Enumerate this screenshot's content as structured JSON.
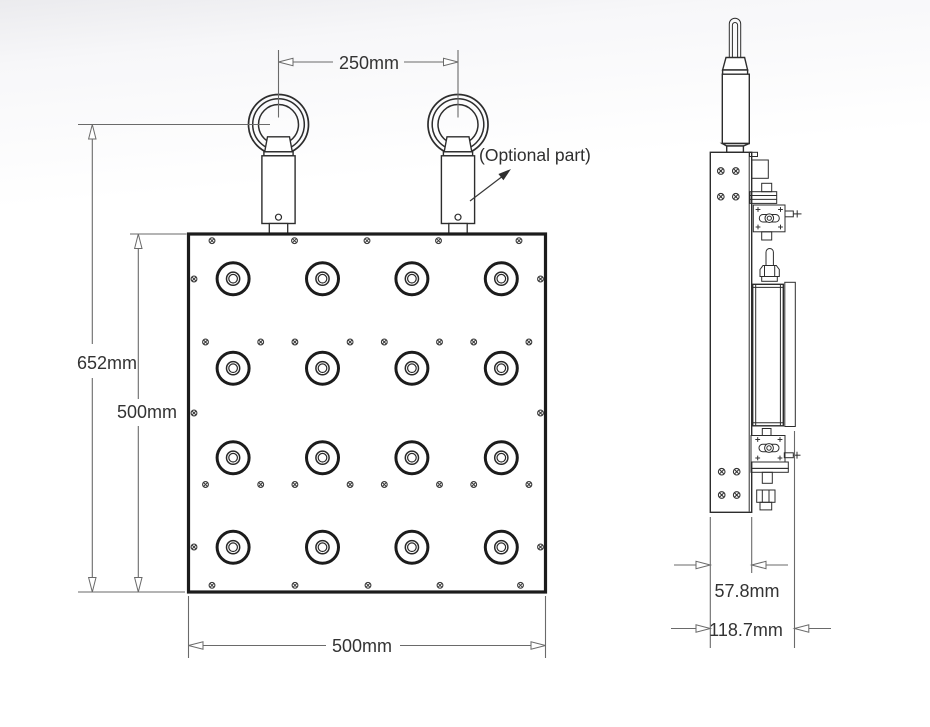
{
  "diagram": {
    "type": "technical-drawing",
    "views": {
      "front": {
        "label": "front-view",
        "dimensions": {
          "eyebolt_spacing": "250mm",
          "overall_height": "652mm",
          "panel_height": "500mm",
          "panel_width": "500mm"
        },
        "annotation": "(Optional part)",
        "transducer_grid": {
          "rows": 4,
          "cols": 4
        },
        "eyebolt_count": 2
      },
      "side": {
        "label": "side-view",
        "dimensions": {
          "body_depth": "57.8mm",
          "overall_depth": "118.7mm"
        }
      }
    },
    "colors": {
      "line": "#2d2d2d",
      "dim_line": "#6a6a6a",
      "text": "#333333",
      "background_top": "#ebebee",
      "background": "#ffffff"
    }
  }
}
